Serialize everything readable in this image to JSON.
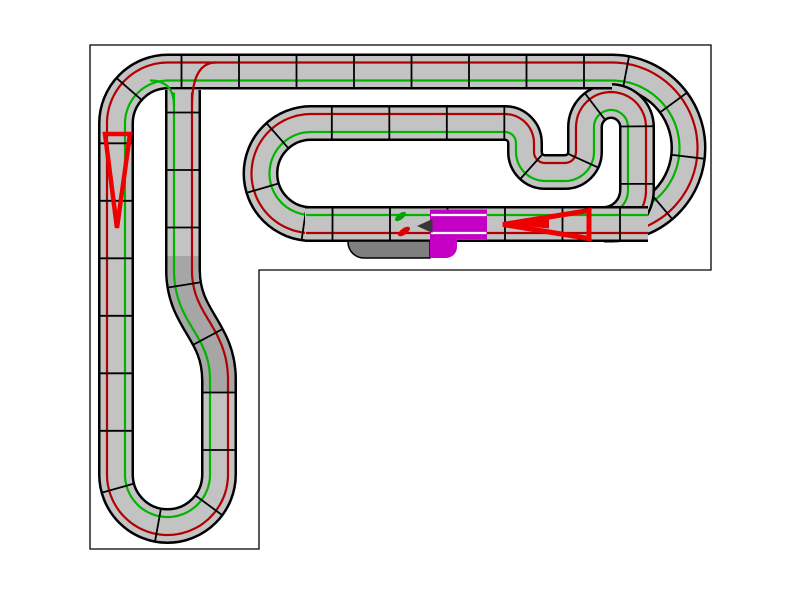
{
  "scene": {
    "width": 800,
    "height": 600,
    "background": "#ffffff",
    "title": ""
  },
  "colors": {
    "canvas_fill": "#ffffff",
    "canvas_border": "#000000",
    "track_surface": "#c3c3c3",
    "track_shade": "#a6a6a6",
    "track_casing": "#000000",
    "lane_red": "#b20000",
    "lane_green": "#00b400",
    "joint": "#000000",
    "lap_counter": "#c400c4",
    "slot_white": "#ffffff",
    "pit_gray": "#7f7f7f",
    "arrow_red": "#ee0000",
    "dark_arrow": "#383838",
    "car_green": "#00a000",
    "car_red": "#dd0000"
  },
  "canvas": {
    "border_path": "M 90,45 L 711,45 L 711,270 L 259,270 L 259,549 L 90,549 Z"
  },
  "track": {
    "band_width": 34,
    "casing_width": 36,
    "surface_width": 31,
    "lane_offset": 9,
    "lane_width": 2.2,
    "joint_spacing": 57.5,
    "joint_first": 28,
    "joint_half_len": 17,
    "joint_width": 1.8,
    "bands": [
      {
        "name": "right-sweep",
        "path": "M 598,71.5 L 612,71.5 A 76.5 76.5 0 0 1 688.5,148 A 76.5 76.5 0 0 1 612,224.5 L 604,224.5",
        "red_side": -1
      },
      {
        "name": "oval-hammerhead",
        "path": "M 332,224 L 311,224 A 50.5 50.5 0 0 1 260.5,173.5 A 50.5 50.5 0 0 1 311,123 L 505,123 A 20 20 0 0 1 525,143 L 525,152 A 20 20 0 0 0 545,172 L 565,172 A 20 20 0 0 0 585,152 L 585,127 A 26 26 0 0 1 611,101 A 26 26 0 0 1 637,127 L 637,190 A 34 34 0 0 1 603,224",
        "red_side": -1
      },
      {
        "name": "outer-west-loop",
        "path": "M 612,71.5 L 168,71.5 A 52 52 0 0 0 116,123.5 L 116,474.5 A 51.5 51.5 0 0 0 167.5,526 A 51.5 51.5 0 0 0 219,474.5 L 219,380 C 219,330 183,320 183,270 L 183,90",
        "red_side": 1,
        "shade_path": "M 219,392 L 219,380 C 219,330 183,320 183,270 L 183,256"
      },
      {
        "name": "start-finish-straight",
        "path": "M 648,224 L 305,224",
        "red_side": -1
      }
    ],
    "lane_merges": [
      {
        "name": "green-lane-merge",
        "color_key": "lane_green",
        "path": "M 174,106 Q 174,80.5 150,80.5"
      },
      {
        "name": "red-lane-merge",
        "color_key": "lane_red",
        "path": "M 192,106 Q 192,62.5 216,62.5"
      }
    ]
  },
  "pieces": [
    {
      "name": "pit-lane-piece",
      "path": "M 430,241 L 430,258 L 364,258 A 16 16 0 0 1 348,242 L 348,241 Z",
      "fill_key": "pit_gray",
      "stroke_key": "track_casing",
      "stroke_width": 1.5
    },
    {
      "name": "lap-counter-piece",
      "path": "M 430,209.5 L 487,209.5 L 487,239 L 457,239 L 457,247 A 11 11 0 0 1 446,258 L 430,258 Z",
      "fill_key": "lap_counter",
      "stroke_width": 0
    }
  ],
  "slot_lines": [
    {
      "name": "lap-counter-slot-top",
      "x1": 431,
      "y1": 215,
      "x2": 486.5,
      "y2": 215
    },
    {
      "name": "lap-counter-slot-bottom",
      "x1": 431,
      "y1": 233,
      "x2": 486.5,
      "y2": 233
    }
  ],
  "markers": {
    "arrow_left": {
      "points": "105,134 130,134 117,228",
      "stroke_width": 4.5
    },
    "arrow_main_outline": {
      "points": "503,224.5 589,210.5 589,238.5",
      "stroke_width": 5
    },
    "arrow_main_solid": {
      "points": "506,224 549,219.5 549,228.5"
    },
    "dark_arrowhead": {
      "points": "417,226 432.5,219 432.5,233"
    },
    "cars": [
      {
        "name": "car-green",
        "cx": 400.5,
        "cy": 216.5,
        "rx": 6.5,
        "ry": 3,
        "rotate": -38,
        "color_key": "car_green"
      },
      {
        "name": "car-red",
        "cx": 404,
        "cy": 231.5,
        "rx": 7,
        "ry": 3.2,
        "rotate": -35,
        "color_key": "car_red"
      }
    ]
  }
}
